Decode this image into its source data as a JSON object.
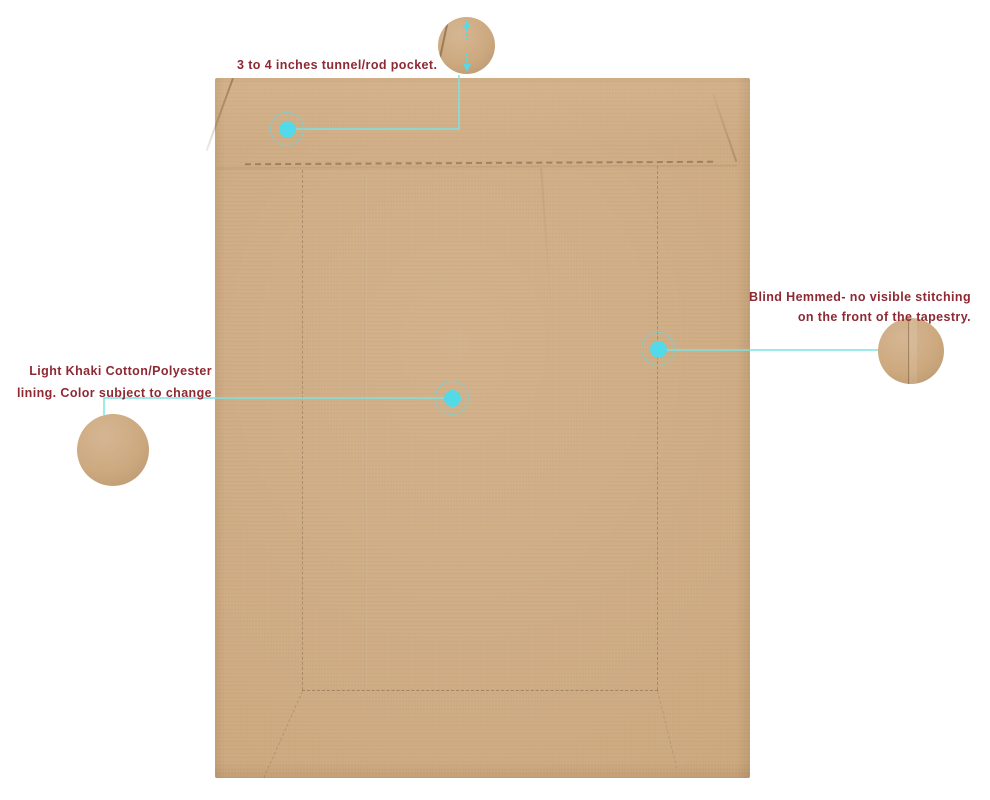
{
  "product": {
    "name": "tapestry-back-lining-panel"
  },
  "colors": {
    "background": "#ffffff",
    "fabric_khaki": "#cda97f",
    "stitch": "#7a5e40",
    "annotation_text": "#8e2933",
    "callout_line": "#7ce3e3",
    "callout_marker_dot": "#54d9e8"
  },
  "annotations": {
    "rod_pocket": {
      "label": "3 to 4 inches tunnel/rod pocket."
    },
    "blind_hem": {
      "line1": "Blind Hemmed- no visible stitching",
      "line2": "on the front of the tapestry."
    },
    "lining": {
      "line1": "Light Khaki Cotton/Polyester",
      "line2": "lining. Color subject to change"
    }
  },
  "icons": {
    "marker": "cyan-dot-with-ring",
    "measure_arrows": "up-and-down-measurement-arrows"
  }
}
